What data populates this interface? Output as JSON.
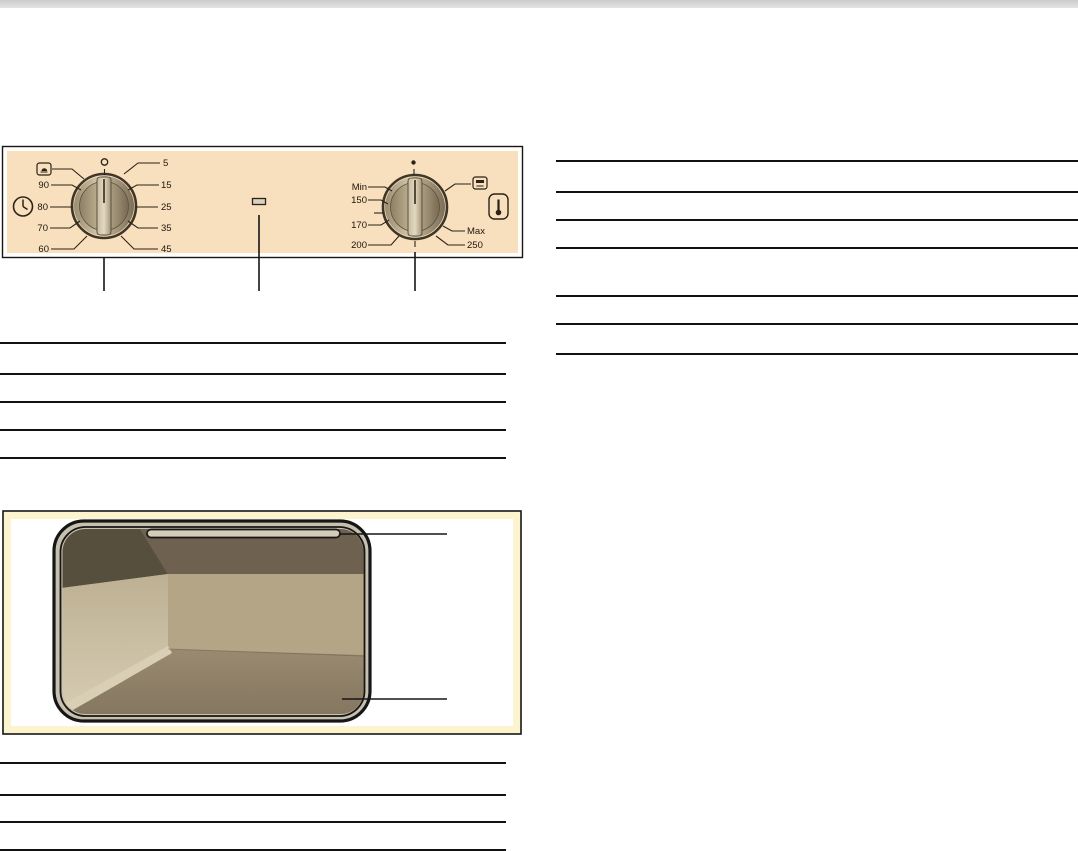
{
  "figures": {
    "control_panel": {
      "description": "oven control panel illustration",
      "timer_knob": {
        "top_symbol": "circle-outline",
        "left_labels": [
          "90",
          "80",
          "70",
          "60"
        ],
        "right_labels": [
          "5",
          "15",
          "25",
          "35",
          "45"
        ],
        "end_icon": "manual-mode-icon",
        "side_icon": "clock-icon"
      },
      "thermostat_knob": {
        "top_symbol": "dot",
        "left_labels": [
          "Min",
          "150",
          "170",
          "200"
        ],
        "right_labels": [
          "Max",
          "250"
        ],
        "end_icon": "grill-icon",
        "side_icon": "thermometer-icon"
      },
      "indicator_lamp": "indicator-lamp",
      "colors": {
        "panel_bg": "#f8dfbd",
        "knob_body": "#b7a98c",
        "outline": "#161616",
        "label_text": "#1c160d"
      }
    },
    "oven_cavity": {
      "description": "oven cavity interior illustration",
      "callout_targets": [
        "grill-element",
        "cavity-floor"
      ],
      "colors": {
        "back_wall": "#b3a586",
        "left_wall": "#c9bca0",
        "floor": "#8e8066",
        "frame": "#c8c0af",
        "ceiling_shadow": "#6e6150",
        "box_inner_border": "#fbf4cf"
      }
    }
  }
}
